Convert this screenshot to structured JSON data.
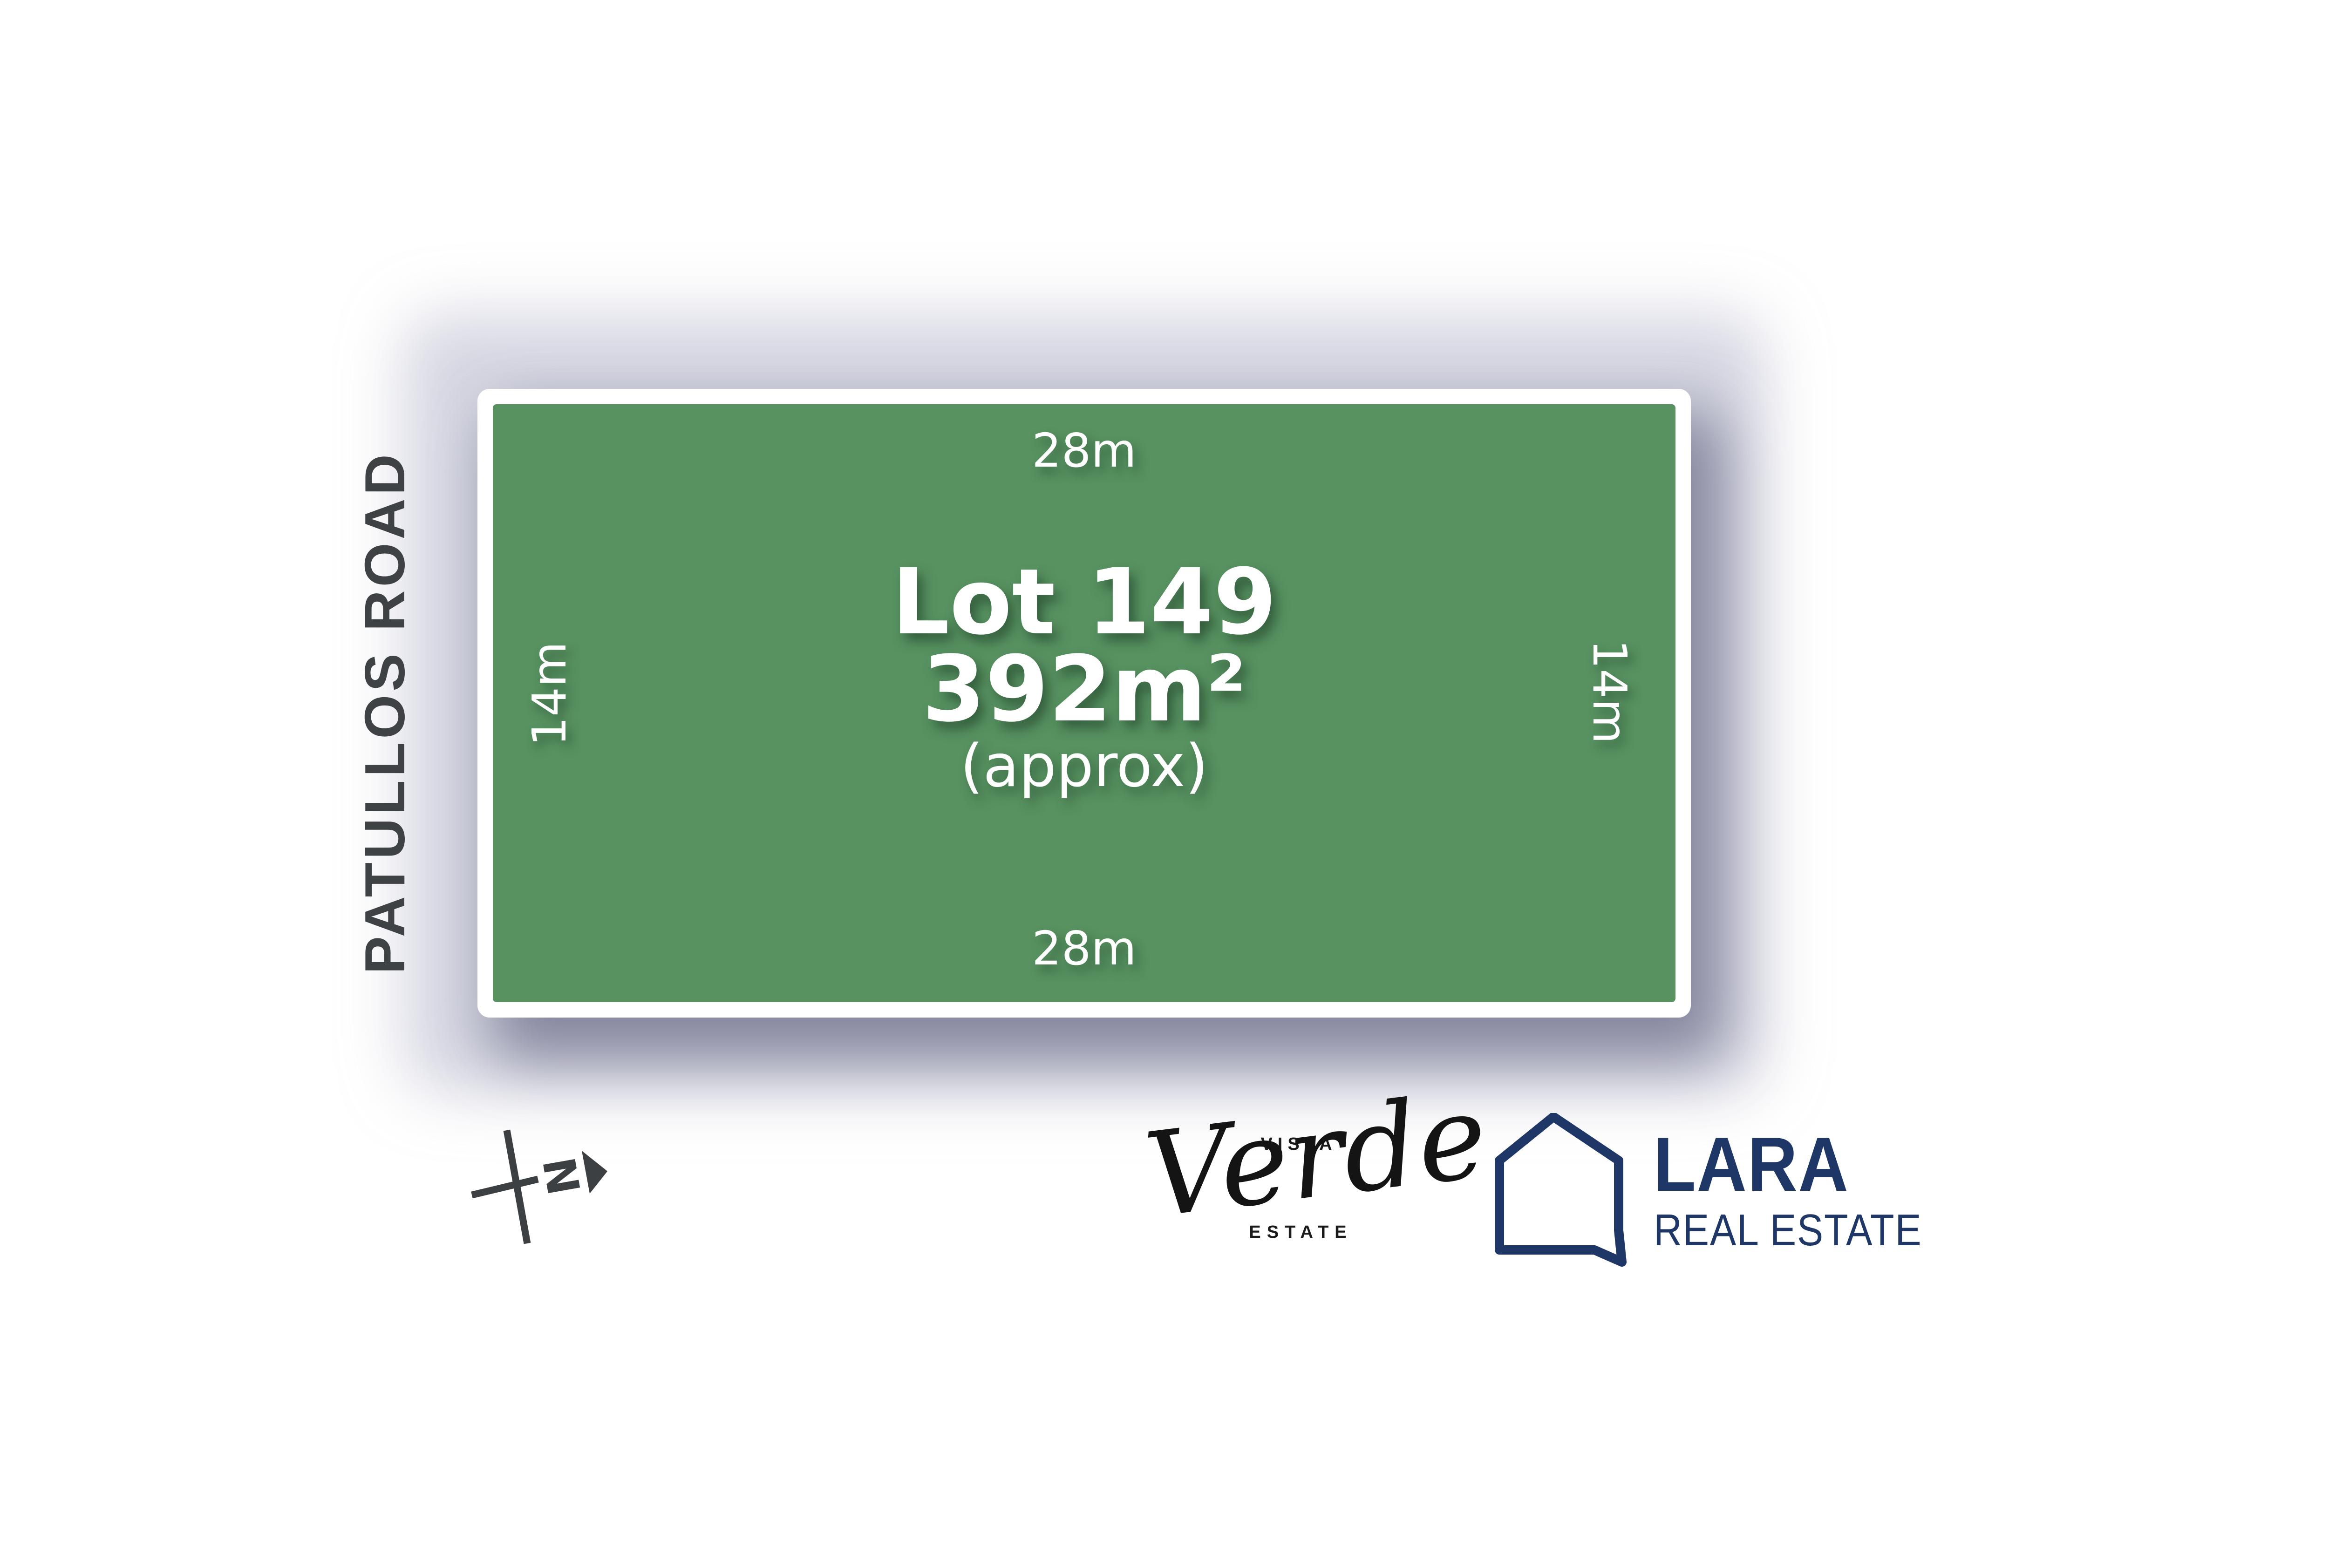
{
  "plan": {
    "lot": {
      "title": "Lot 149",
      "area": "392m²",
      "approx": "(approx)",
      "width_top": "28m",
      "width_bottom": "28m",
      "depth_left": "14m",
      "depth_right": "14m"
    },
    "road": {
      "name": "PATULLOS ROAD"
    },
    "compass": {
      "north": "N"
    },
    "estate_logo": {
      "word_top": "VISTA",
      "word_script": "Verde",
      "word_bottom": "ESTATE"
    },
    "agency_logo": {
      "name": "LARA",
      "tagline": "REAL ESTATE"
    },
    "colors": {
      "lot_green": "#589261",
      "card_white": "#ffffff",
      "road_gray": "#3e4245",
      "compass_gray": "#3d4043",
      "agency_navy": "#1e3766",
      "logo_ink": "#161616",
      "shadow_lavender": "#a9abc4"
    }
  }
}
